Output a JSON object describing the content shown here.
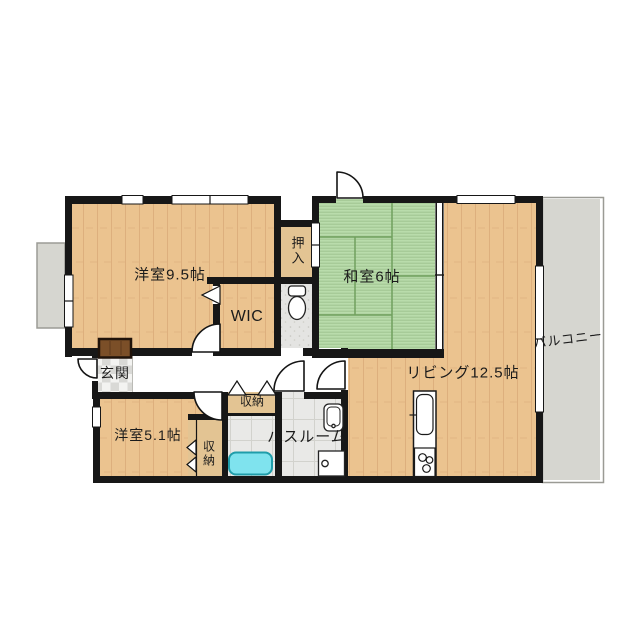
{
  "plan_title": "2LDK apartment floor plan",
  "rooms": {
    "western1": {
      "label": "洋室9.5帖"
    },
    "wic": {
      "label": "WIC"
    },
    "oshiire": {
      "label": "押入"
    },
    "japanese": {
      "label": "和室6帖"
    },
    "living": {
      "label": "リビング12.5帖"
    },
    "balcony": {
      "label": "バルコニー"
    },
    "entrance": {
      "label": "玄関"
    },
    "western2": {
      "label": "洋室5.1帖"
    },
    "storage_hall": {
      "label": "収納"
    },
    "storage_west2": {
      "label": "収納"
    },
    "bathroom": {
      "label": "バスルーム"
    }
  },
  "colors": {
    "wall": "#171717",
    "wood": "#ebc38f",
    "wood_grain": "#d8a877",
    "tatami": "#b9dcab",
    "tatami_line": "#71a05e",
    "closet": "#e3c493",
    "balcony": "#d6d6d0",
    "tile": "#e9e9e7",
    "toilet_floor": "#e4e4e2",
    "tub_fill": "#7fe3ee",
    "tub_stroke": "#1f9daa",
    "doormat": "#7b4f28",
    "text": "#1b1b1b"
  }
}
